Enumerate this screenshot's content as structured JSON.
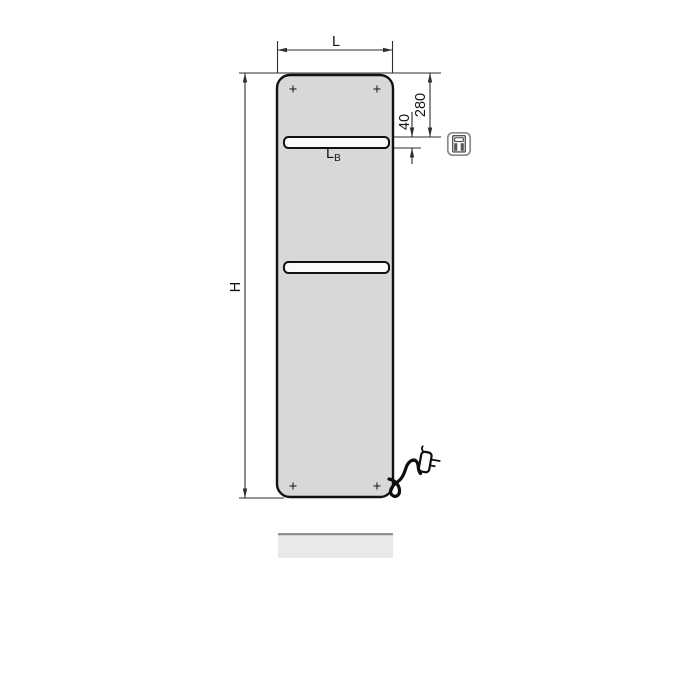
{
  "diagram": {
    "type": "technical-dimension-drawing",
    "subject": "flat-panel-electric-radiator-front-view",
    "dimension_labels": {
      "overall_width": "L",
      "overall_height": "H",
      "bar_length_main": "L",
      "bar_length_sub": "B",
      "top_to_bar": "280",
      "bar_slot_height": "40"
    },
    "icons": [
      "electric-control-unit-icon",
      "power-plug-icon",
      "mounting-hole-marker"
    ],
    "colors": {
      "panel_fill": "#d8d8d8",
      "rail_fill": "#fbfbfb",
      "outline": "#111111",
      "dimension_line": "#2e2e2e",
      "shadow_bar_fill": "#e9e9e9",
      "shadow_bar_edge": "#8c8c8c",
      "icon_frame": "#8a8a8a",
      "background": "#ffffff"
    }
  }
}
